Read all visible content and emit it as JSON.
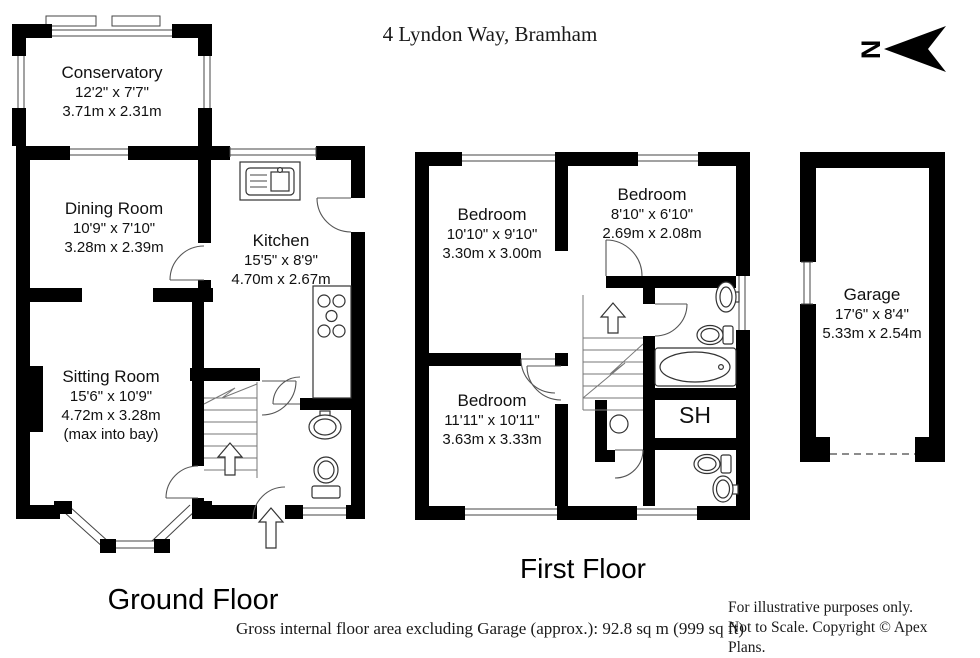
{
  "title": "4 Lyndon Way, Bramham",
  "north": {
    "label": "N"
  },
  "floors": {
    "ground": {
      "label": "Ground Floor",
      "rooms": {
        "conservatory": {
          "name": "Conservatory",
          "dims_ft": "12'2\" x 7'7\"",
          "dims_m": "3.71m x 2.31m"
        },
        "dining_room": {
          "name": "Dining Room",
          "dims_ft": "10'9\" x 7'10\"",
          "dims_m": "3.28m x 2.39m"
        },
        "kitchen": {
          "name": "Kitchen",
          "dims_ft": "15'5\" x 8'9\"",
          "dims_m": "4.70m x 2.67m"
        },
        "sitting_room": {
          "name": "Sitting Room",
          "dims_ft": "15'6\" x 10'9\"",
          "dims_m": "4.72m x 3.28m",
          "note": "(max into bay)"
        }
      }
    },
    "first": {
      "label": "First Floor",
      "rooms": {
        "bedroom_1": {
          "name": "Bedroom",
          "dims_ft": "10'10\" x 9'10\"",
          "dims_m": "3.30m x 3.00m"
        },
        "bedroom_2": {
          "name": "Bedroom",
          "dims_ft": "8'10\" x 6'10\"",
          "dims_m": "2.69m x 2.08m"
        },
        "bedroom_3": {
          "name": "Bedroom",
          "dims_ft": "11'11\" x 10'11\"",
          "dims_m": "3.63m x 3.33m"
        },
        "shower_room": {
          "name": "SH"
        }
      }
    },
    "garage": {
      "rooms": {
        "garage": {
          "name": "Garage",
          "dims_ft": "17'6\" x 8'4\"",
          "dims_m": "5.33m x 2.54m"
        }
      }
    }
  },
  "footer": {
    "area_note": "Gross internal floor area excluding Garage (approx.): 92.8 sq m (999 sq ft)",
    "disclaimer_1": "For illustrative purposes only.",
    "disclaimer_2": "Not to Scale. Copyright © Apex Plans."
  },
  "colors": {
    "wall": "#000000",
    "background": "#ffffff"
  }
}
